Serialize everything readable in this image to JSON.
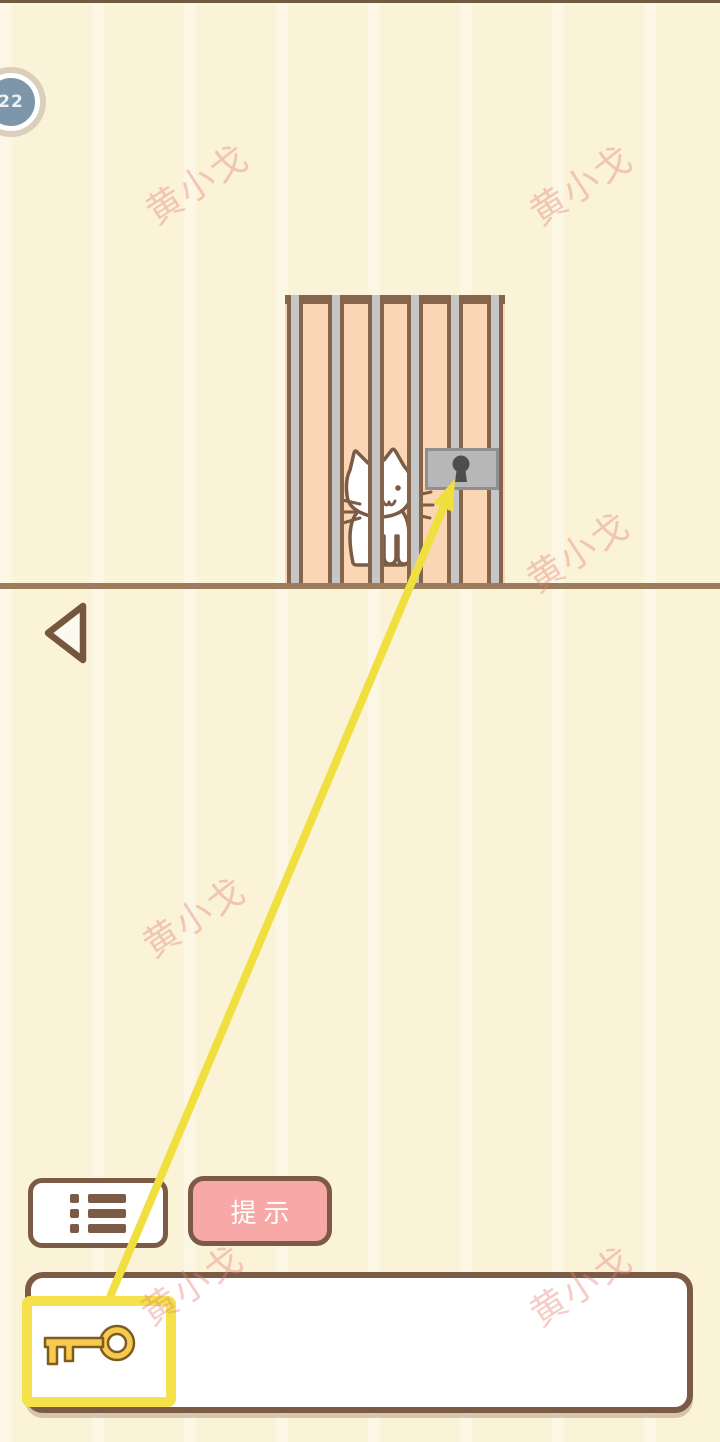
{
  "hud": {
    "level": "22",
    "badge_icon": "circle-level-badge"
  },
  "watermark": {
    "text": "黄小戈",
    "color": "#E8827A"
  },
  "scene": {
    "cat_icon": "white-cat-behind-bars",
    "cage_icon": "cage-with-vertical-bars",
    "lock_icon": "padlock-keyhole",
    "connector_icon": "yellow-arrow-key-to-lock",
    "ground": "horizontal-ground-line"
  },
  "controls": {
    "back_icon": "triangle-left",
    "menu_icon": "list-bullets",
    "hint_label": "提示"
  },
  "inventory": {
    "selected_item": "key",
    "key_icon": "gold-key",
    "slot_count_visible": 1
  },
  "colors": {
    "background": "#FAF3D7",
    "cage_fill": "#FBD6B4",
    "outline_brown": "#7B5B45",
    "bar_gray": "#C6C6C6",
    "ground": "#9B7C5C",
    "accent_yellow": "#F2E243",
    "selection_yellow": "#F5E14A",
    "hint_pink": "#F8A8A6",
    "lock_gray": "#B7B7B7",
    "keyhole_dark": "#4D4D4D",
    "key_gold": "#F6C94F",
    "badge_blue": "#7E96AA",
    "badge_ring": "#D9CFBA"
  }
}
